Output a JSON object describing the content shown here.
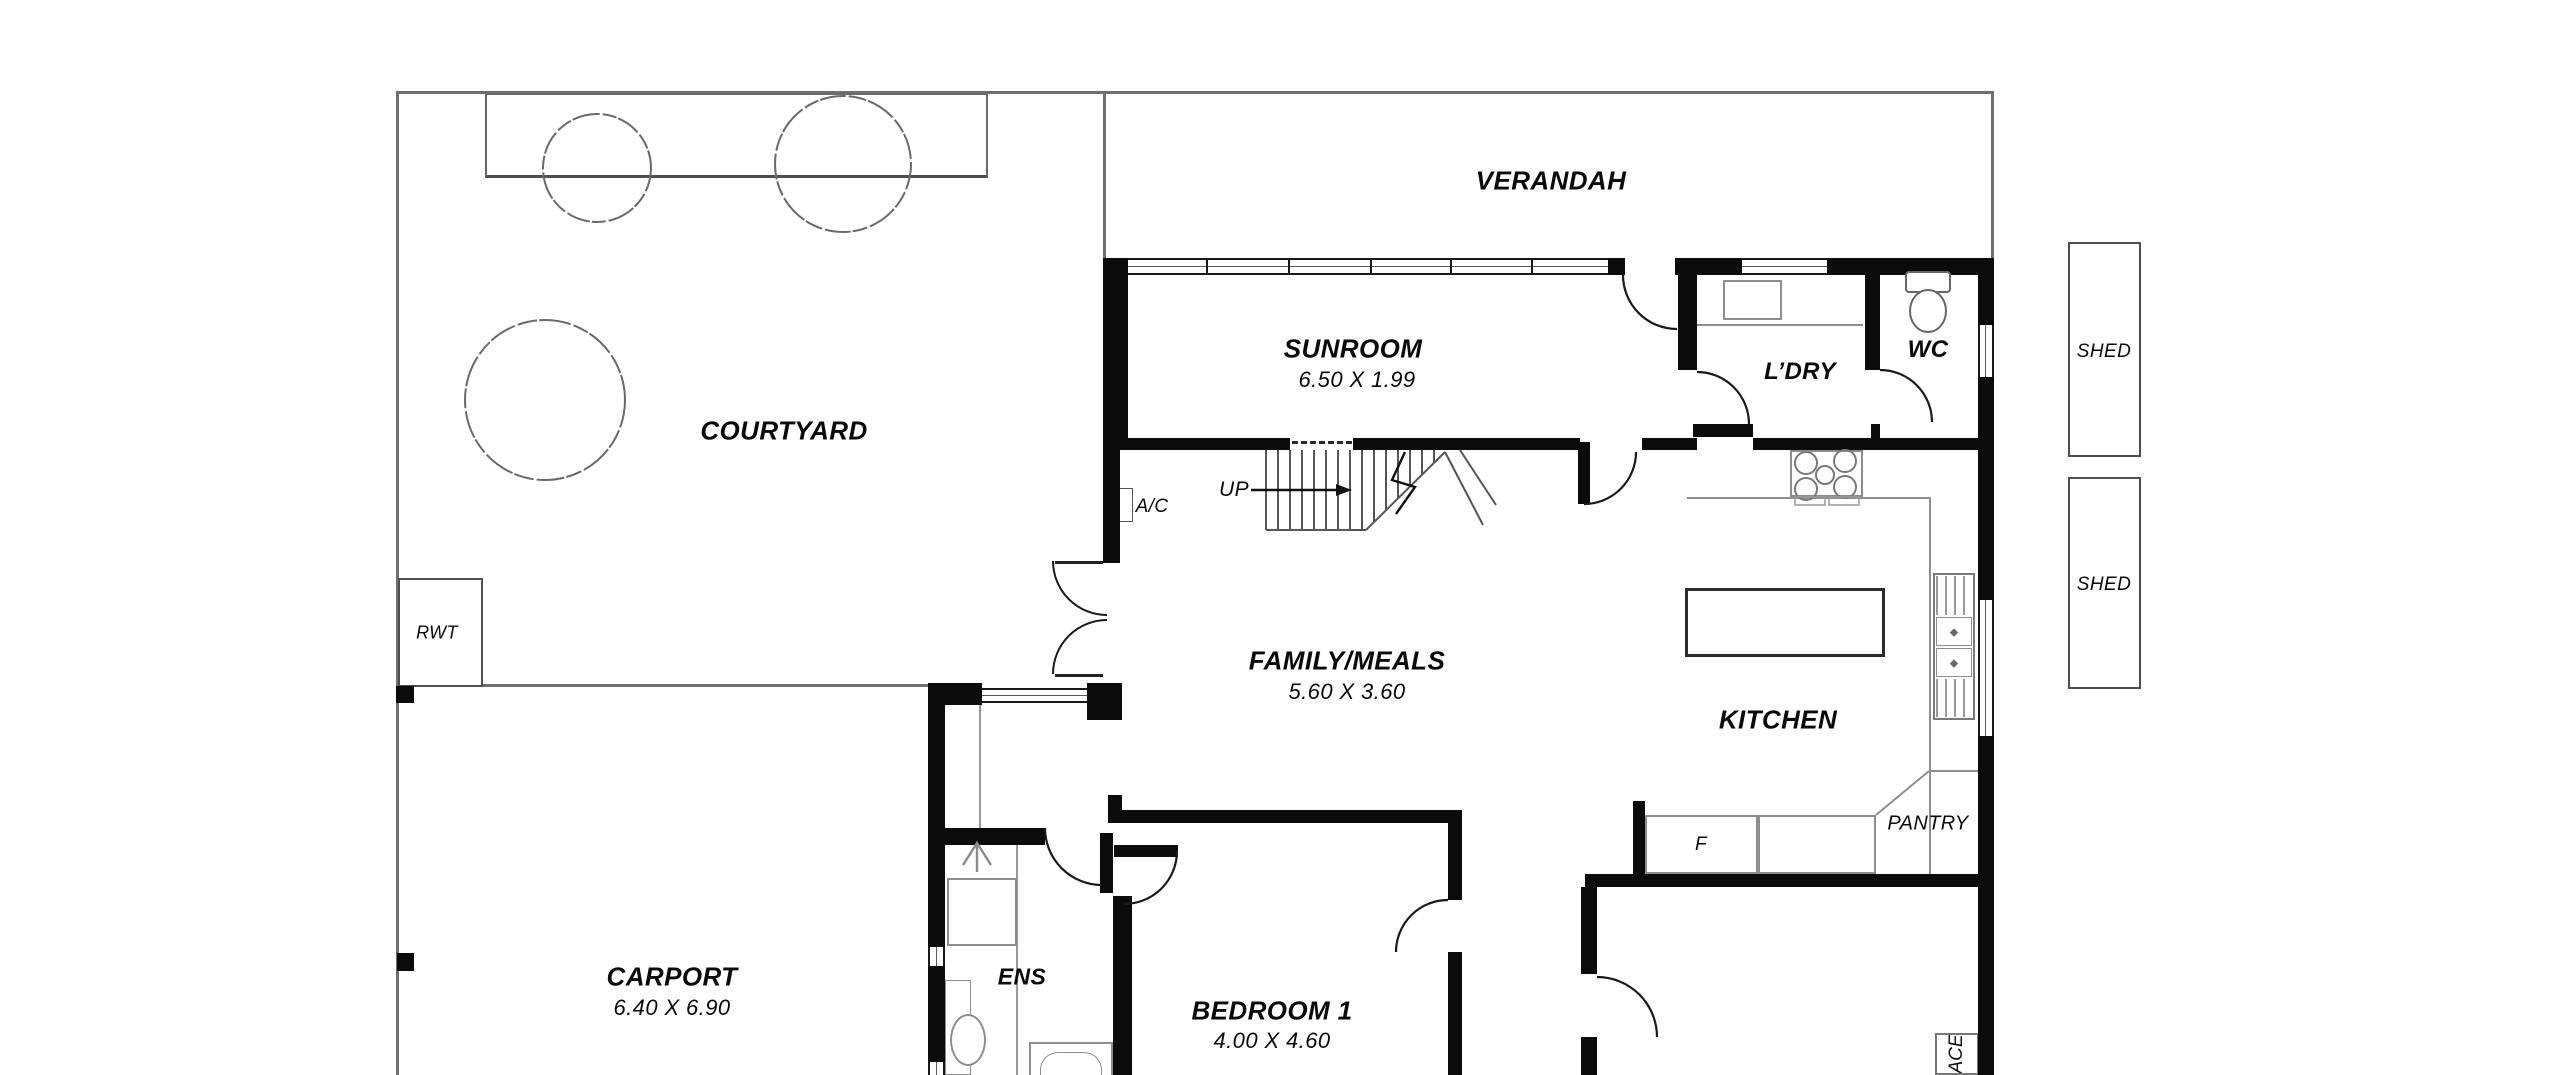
{
  "plan": {
    "type": "residential floor plan",
    "labels": {
      "verandah": "VERANDAH",
      "courtyard": "COURTYARD",
      "sunroom": "SUNROOM",
      "sunroom_dims": "6.50 X 1.99",
      "laundry": "L’DRY",
      "wc": "WC",
      "shed_top": "SHED",
      "shed_bottom": "SHED",
      "rwt": "RWT",
      "ac": "A/C",
      "up": "UP",
      "family": "FAMILY/MEALS",
      "family_dims": "5.60 X 3.60",
      "kitchen": "KITCHEN",
      "fridge": "F",
      "pantry": "PANTRY",
      "carport": "CARPORT",
      "carport_dims": "6.40 X 6.90",
      "ens": "ENS",
      "bedroom1": "BEDROOM 1",
      "bedroom1_dims": "4.00 X 4.60",
      "fireplace_partial": "ACE"
    },
    "colors": {
      "wall": "#0b0b0b",
      "boundary_line": "#6e6e6e",
      "fixture_line": "#8e8e8e",
      "text": "#0a0a0a",
      "background": "#ffffff"
    }
  }
}
